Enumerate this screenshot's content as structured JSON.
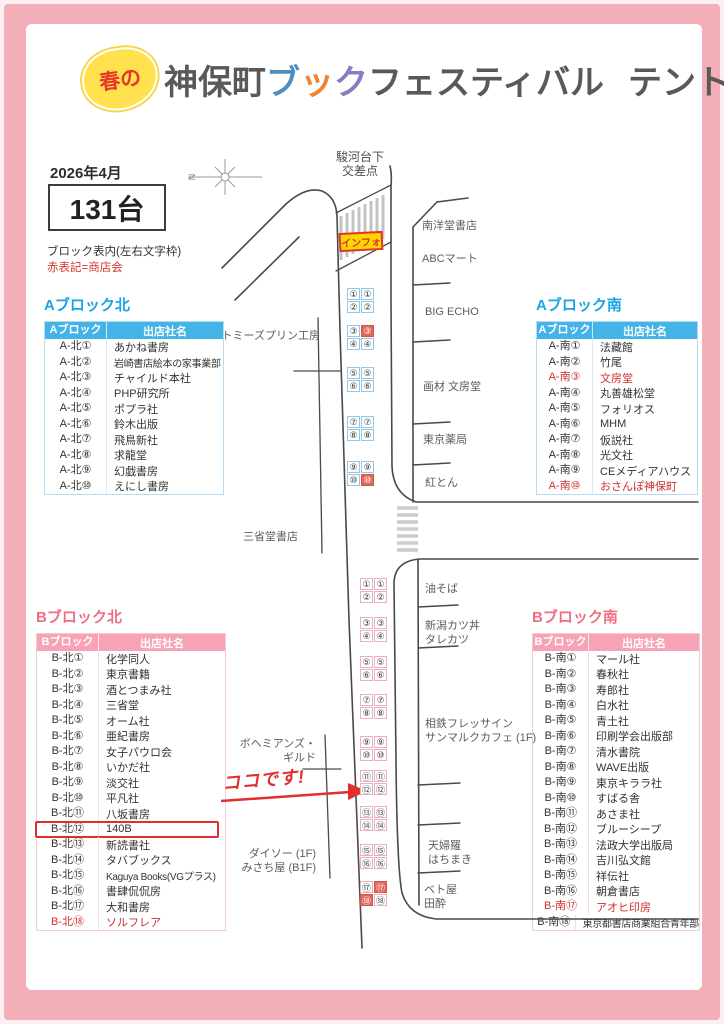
{
  "header": {
    "badge": "春の",
    "jinbocho": "神保町",
    "book_chars": [
      {
        "c": "ブ",
        "color": "#4e8fc0"
      },
      {
        "c": "ッ",
        "color": "#f08334"
      },
      {
        "c": "ク",
        "color": "#8a7cc2"
      }
    ],
    "festival": "フェスティバル",
    "subtitle": "テント・ワゴン配置図"
  },
  "info": {
    "date": "2026年4月",
    "count": "131台",
    "legend_line1": "ブロック表内(左右文字枠)",
    "legend_line2": "赤表記=商店会",
    "compass_n": "N"
  },
  "colors": {
    "accent_blue": "#18a3e4",
    "accent_pink": "#ef6e82",
    "red_text": "#cc3030",
    "info_yellow": "#ffd600",
    "tent_red_fill": "#e0685a",
    "frame_pink": "#f3aeb8"
  },
  "tables": {
    "a_north": {
      "title": "Aブロック北",
      "col1": "Aブロック",
      "col2": "出店社名",
      "prefix": "A-北",
      "rows": [
        {
          "no": "①",
          "name": "あかね書房"
        },
        {
          "no": "②",
          "name": "岩崎書店絵本の家事業部"
        },
        {
          "no": "③",
          "name": "チャイルド本社"
        },
        {
          "no": "④",
          "name": "PHP研究所"
        },
        {
          "no": "⑤",
          "name": "ポプラ社"
        },
        {
          "no": "⑥",
          "name": "鈴木出版"
        },
        {
          "no": "⑦",
          "name": "飛鳥新社"
        },
        {
          "no": "⑧",
          "name": "求龍堂"
        },
        {
          "no": "⑨",
          "name": "幻戯書房"
        },
        {
          "no": "⑩",
          "name": "えにし書房"
        }
      ]
    },
    "a_south": {
      "title": "Aブロック南",
      "col1": "Aブロック",
      "col2": "出店社名",
      "prefix": "A-南",
      "rows": [
        {
          "no": "①",
          "name": "法藏館"
        },
        {
          "no": "②",
          "name": "竹尾"
        },
        {
          "no": "③",
          "name": "文房堂",
          "red": true
        },
        {
          "no": "④",
          "name": "丸善雄松堂"
        },
        {
          "no": "⑤",
          "name": "フォリオス"
        },
        {
          "no": "⑥",
          "name": "MHM"
        },
        {
          "no": "⑦",
          "name": "仮説社"
        },
        {
          "no": "⑧",
          "name": "光文社"
        },
        {
          "no": "⑨",
          "name": "CEメディアハウス"
        },
        {
          "no": "⑩",
          "name": "おさんぽ神保町",
          "red": true
        }
      ]
    },
    "b_north": {
      "title": "Bブロック北",
      "col1": "Bブロック",
      "col2": "出店社名",
      "prefix": "B-北",
      "rows": [
        {
          "no": "①",
          "name": "化学同人"
        },
        {
          "no": "②",
          "name": "東京書籍"
        },
        {
          "no": "③",
          "name": "酒とつまみ社"
        },
        {
          "no": "④",
          "name": "三省堂"
        },
        {
          "no": "⑤",
          "name": "オーム社"
        },
        {
          "no": "⑥",
          "name": "亜紀書房"
        },
        {
          "no": "⑦",
          "name": "女子パウロ会"
        },
        {
          "no": "⑧",
          "name": "いかだ社"
        },
        {
          "no": "⑨",
          "name": "淡交社"
        },
        {
          "no": "⑩",
          "name": "平凡社"
        },
        {
          "no": "⑪",
          "name": "八坂書房"
        },
        {
          "no": "⑫",
          "name": "140B",
          "boxed": true
        },
        {
          "no": "⑬",
          "name": "新読書社"
        },
        {
          "no": "⑭",
          "name": "タバブックス"
        },
        {
          "no": "⑮",
          "name": "Kaguya Books(VGプラス)"
        },
        {
          "no": "⑯",
          "name": "書肆侃侃房"
        },
        {
          "no": "⑰",
          "name": "大和書房"
        },
        {
          "no": "⑱",
          "name": "ソルフレア",
          "red": true
        }
      ]
    },
    "b_south": {
      "title": "Bブロック南",
      "col1": "Bブロック",
      "col2": "出店社名",
      "prefix": "B-南",
      "rows": [
        {
          "no": "①",
          "name": "マール社"
        },
        {
          "no": "②",
          "name": "春秋社"
        },
        {
          "no": "③",
          "name": "寿郎社"
        },
        {
          "no": "④",
          "name": "白水社"
        },
        {
          "no": "⑤",
          "name": "青土社"
        },
        {
          "no": "⑥",
          "name": "印刷学会出版部"
        },
        {
          "no": "⑦",
          "name": "清水書院"
        },
        {
          "no": "⑧",
          "name": "WAVE出版"
        },
        {
          "no": "⑨",
          "name": "東京キララ社"
        },
        {
          "no": "⑩",
          "name": "すばる舎"
        },
        {
          "no": "⑪",
          "name": "あさま社"
        },
        {
          "no": "⑫",
          "name": "ブルーシープ"
        },
        {
          "no": "⑬",
          "name": "法政大学出版局"
        },
        {
          "no": "⑭",
          "name": "吉川弘文館"
        },
        {
          "no": "⑮",
          "name": "祥伝社"
        },
        {
          "no": "⑯",
          "name": "朝倉書店"
        },
        {
          "no": "⑰",
          "name": "アオヒ印房",
          "red": true
        },
        {
          "no": "⑱",
          "name": "東京都書店商業組合青年部"
        }
      ]
    }
  },
  "map": {
    "intersection": "駿河台下\n交差点",
    "info_box": "インフォ",
    "annotation": "ココです!",
    "labels": {
      "nanyodo": "南洋堂書店",
      "abc_mart": "ABCマート",
      "big_echo": "BIG ECHO",
      "gazai_bunbodo": "画材 文房堂",
      "tokyo_yakkyoku": "東京薬局",
      "beniton": "紅とん",
      "aburasoba": "油そば",
      "tarekatsu": "新潟カツ丼\nタレカツ",
      "sotetsu": "相鉄フレッサイン\nサンマルクカフェ (1F)",
      "tempura": "天婦羅\nはちまき",
      "betoya": "ベト屋\n田酔",
      "tommys": "トミーズプリン工房",
      "sanseido": "三省堂書店",
      "bohemians": "ボヘミアンズ・\nギルド",
      "daiso": "ダイソー (1F)\nみさち屋 (B1F)"
    },
    "tents": {
      "a": {
        "x": 347,
        "style": "a",
        "groups": [
          {
            "y": 288,
            "nums": [
              "①",
              "②"
            ],
            "red": [
              "",
              ""
            ]
          },
          {
            "y": 325,
            "nums": [
              "③",
              "④"
            ],
            "red": [
              "r",
              ""
            ]
          },
          {
            "y": 367,
            "nums": [
              "⑤",
              "⑥"
            ],
            "red": [
              "",
              ""
            ]
          },
          {
            "y": 416,
            "nums": [
              "⑦",
              "⑧"
            ],
            "red": [
              "",
              ""
            ]
          },
          {
            "y": 461,
            "nums": [
              "⑨",
              "⑩"
            ],
            "red": [
              "",
              "r"
            ]
          }
        ]
      },
      "b": {
        "x": 360,
        "style": "b",
        "groups": [
          {
            "y": 578,
            "nums": [
              "①",
              "②"
            ],
            "red": [
              "",
              ""
            ]
          },
          {
            "y": 617,
            "nums": [
              "③",
              "④"
            ],
            "red": [
              "",
              ""
            ]
          },
          {
            "y": 656,
            "nums": [
              "⑤",
              "⑥"
            ],
            "red": [
              "",
              ""
            ]
          },
          {
            "y": 694,
            "nums": [
              "⑦",
              "⑧"
            ],
            "red": [
              "",
              ""
            ]
          },
          {
            "y": 736,
            "nums": [
              "⑨",
              "⑩"
            ],
            "red": [
              "",
              ""
            ]
          },
          {
            "y": 770,
            "nums": [
              "⑪",
              "⑫"
            ],
            "red": [
              "",
              ""
            ]
          },
          {
            "y": 806,
            "nums": [
              "⑬",
              "⑭"
            ],
            "red": [
              "",
              ""
            ]
          },
          {
            "y": 844,
            "nums": [
              "⑮",
              "⑯"
            ],
            "red": [
              "",
              ""
            ]
          },
          {
            "y": 881,
            "nums": [
              "⑰",
              "⑱"
            ],
            "red": [
              "r",
              "l"
            ]
          }
        ]
      }
    }
  }
}
